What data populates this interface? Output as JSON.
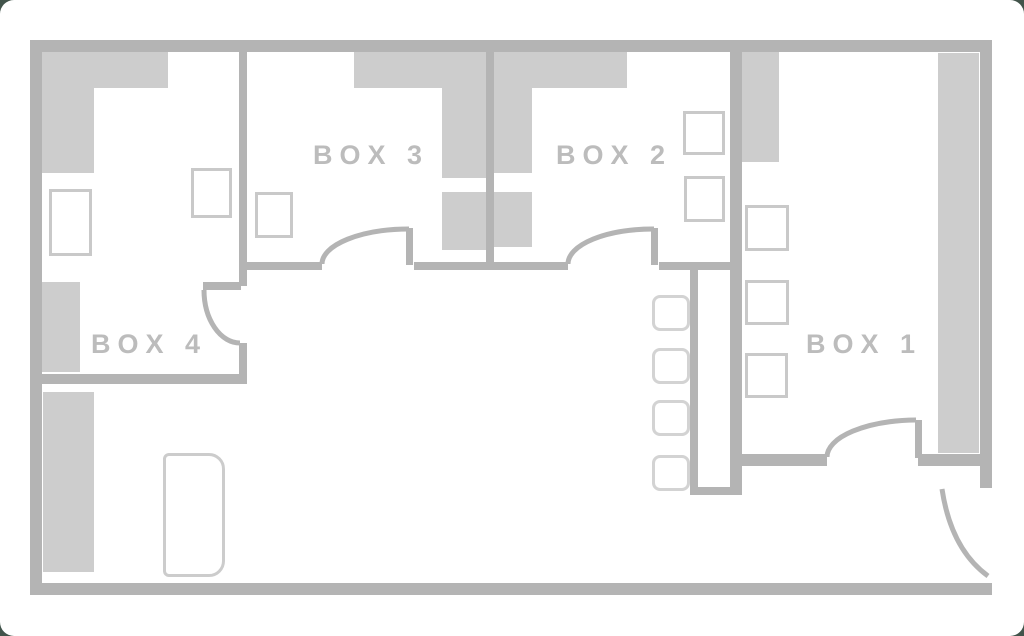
{
  "plan": {
    "title": "Floor plan with four box rooms",
    "rooms": [
      {
        "id": "box-1",
        "label": "BOX 1"
      },
      {
        "id": "box-2",
        "label": "BOX 2"
      },
      {
        "id": "box-3",
        "label": "BOX 3"
      },
      {
        "id": "box-4",
        "label": "BOX 4"
      }
    ],
    "colors": {
      "wall": "#b4b4b4",
      "furniture_fill": "#cdcdcd",
      "furniture_outline": "#c9c9c9",
      "seat_outline": "#d3d3d3",
      "label_text": "#bcbcbc",
      "canvas": "#ffffff",
      "backdrop": "#42544b"
    },
    "counts": {
      "rooms": 4,
      "interior_doors": 4,
      "entrance_doors": 1,
      "hall_seats": 4
    }
  }
}
